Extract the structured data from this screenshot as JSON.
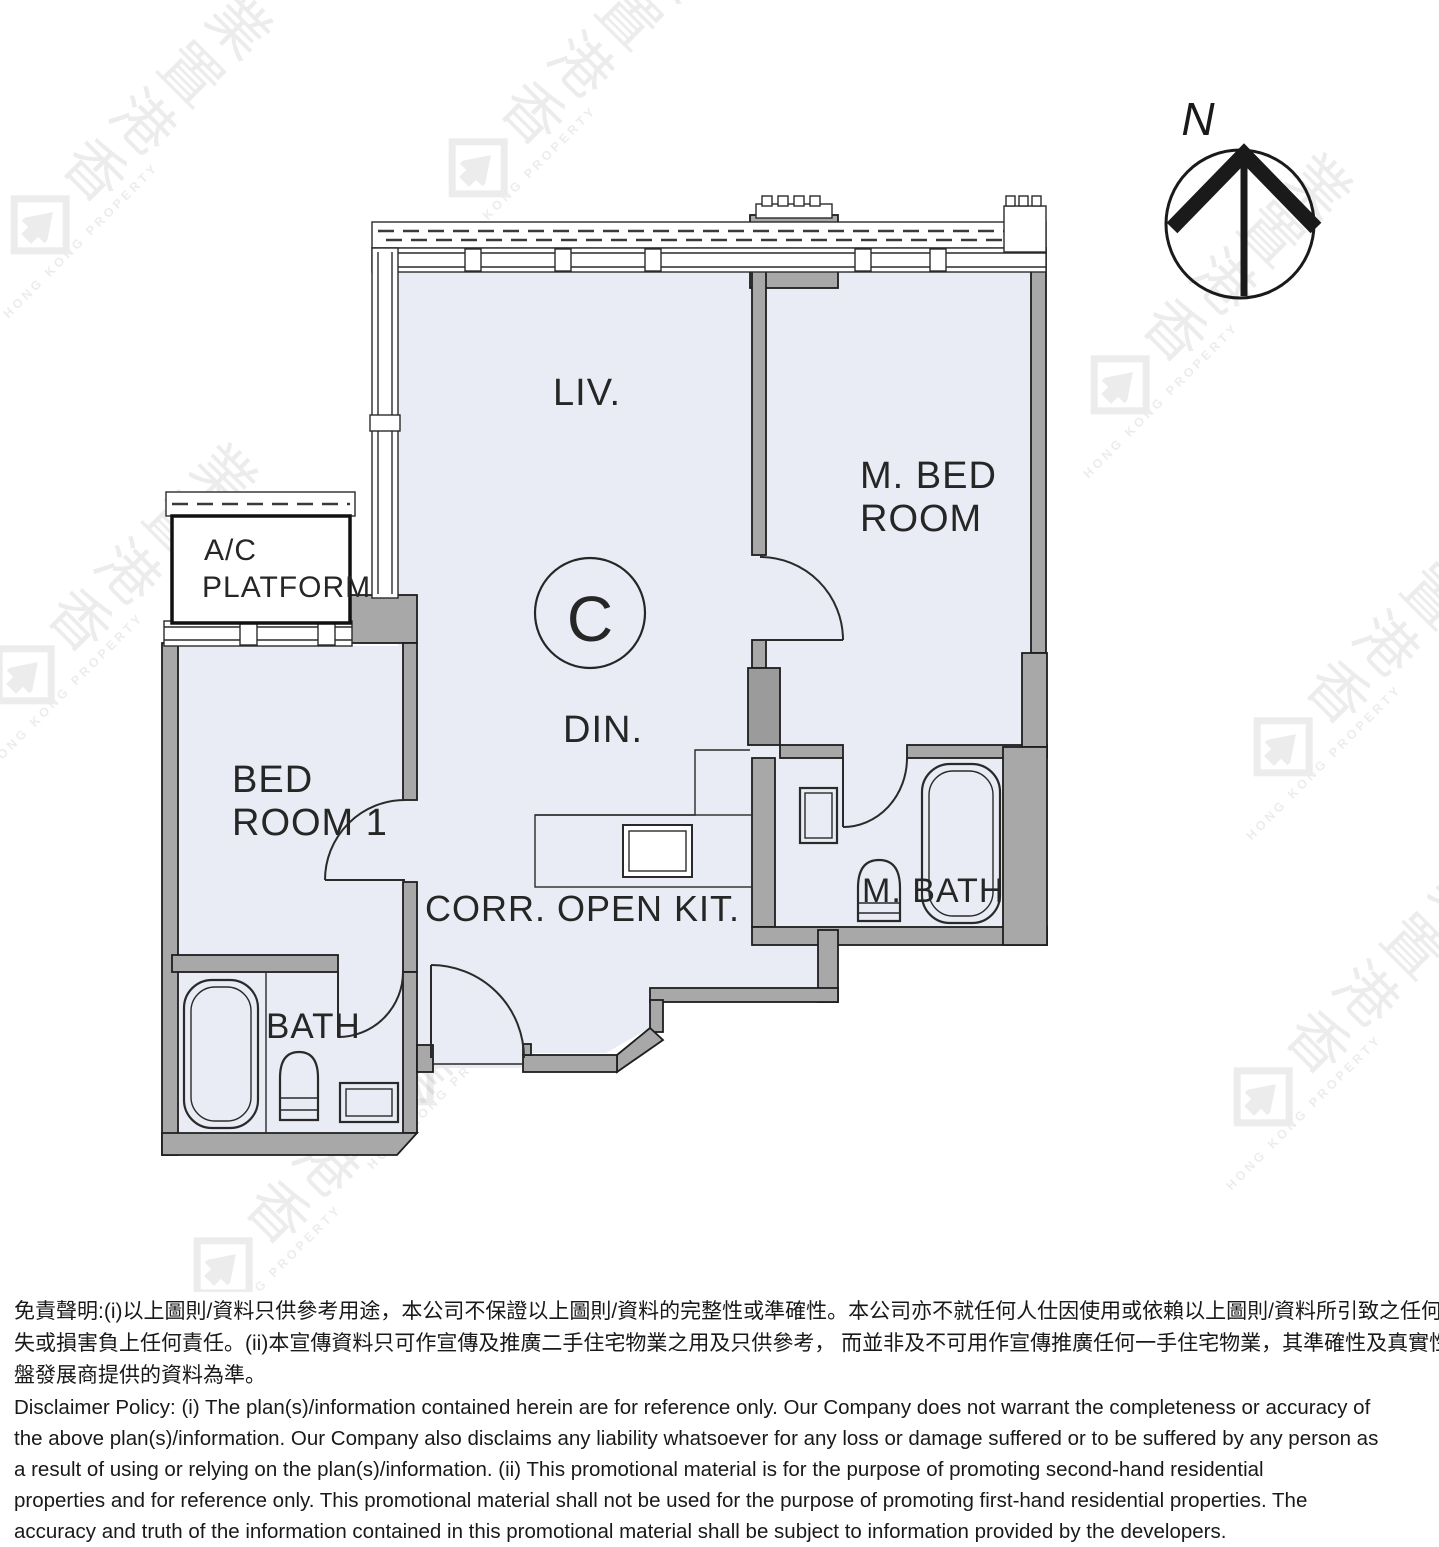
{
  "plan": {
    "unit_label": "C",
    "compass_letter": "N",
    "labels": {
      "liv": "LIV.",
      "din": "DIN.",
      "mbed_line1": "M.  BED",
      "mbed_line2": "ROOM",
      "bed1_line1": "BED",
      "bed1_line2": "ROOM 1",
      "ac_line1": "A/C",
      "ac_line2": "PLATFORM",
      "corr_kit": "CORR. OPEN KIT.",
      "bath": "BATH",
      "mbath": "M.  BATH"
    }
  },
  "watermark": {
    "cjk": [
      "香",
      "港",
      "置",
      "業"
    ],
    "latin": "HONG KONG PROPERTY"
  },
  "disclaimer": {
    "zh_lines": [
      "免責聲明:(i)以上圖則/資料只供參考用途，本公司不保證以上圖則/資料的完整性或準確性。本公司亦不就任何人仕因使用或依賴以上圖則/資料所引致之任何損",
      "失或損害負上任何責任。(ii)本宣傳資料只可作宣傳及推廣二手住宅物業之用及只供參考， 而並非及不可用作宣傳推廣任何一手住宅物業，其準確性及真實性以樓",
      "盤發展商提供的資料為準。"
    ],
    "en_lines": [
      "Disclaimer Policy: (i) The plan(s)/information contained herein are for reference only. Our Company does not warrant the completeness or accuracy of",
      "the above plan(s)/information. Our Company also disclaims any liability whatsoever for any loss or damage suffered or to be suffered by any person as",
      "a result of using or relying on the plan(s)/information. (ii) This promotional material is for the purpose of promoting second-hand residential",
      "properties and for reference only. This promotional material shall not be used for the purpose of promoting first-hand residential properties. The",
      "accuracy and truth of the information contained in this promotional material shall be subject to information provided by the developers."
    ]
  },
  "colors": {
    "floor_fill": "#e9ecf4",
    "wall_fill": "#a8a8a8",
    "line": "#2a2a2a",
    "watermark": "#8f8f8f",
    "background": "#ffffff"
  }
}
